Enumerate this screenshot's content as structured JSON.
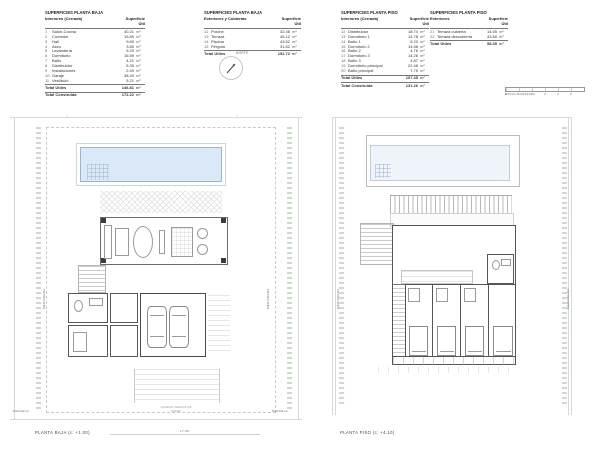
{
  "header": {
    "tables": [
      {
        "title": "SUPERFICIES PLANTA BAJA",
        "group": "Interiores (Cerrada)",
        "value_col": "Superficie Útil",
        "rows": [
          [
            "1",
            "Salón-Cocina",
            "40.21",
            "m²"
          ],
          [
            "2",
            "Comedor",
            "15.80",
            "m²"
          ],
          [
            "3",
            "Hall",
            "9.60",
            "m²"
          ],
          [
            "4",
            "Aseo",
            "3.80",
            "m²"
          ],
          [
            "5",
            "Lavandería",
            "5.20",
            "m²"
          ],
          [
            "6",
            "Dormitorio",
            "16.59",
            "m²"
          ],
          [
            "7",
            "Baño",
            "4.21",
            "m²"
          ],
          [
            "8",
            "Distribuidor",
            "5.30",
            "m²"
          ],
          [
            "9",
            "Instalaciones",
            "2.49",
            "m²"
          ],
          [
            "10",
            "Garaje",
            "38.40",
            "m²"
          ],
          [
            "11",
            "Vestíbulo",
            "5.21",
            "m²"
          ]
        ],
        "totals": [
          [
            "Total Útiles",
            "146.81",
            "m²"
          ],
          [
            "Total Construida",
            "172.22",
            "m²"
          ]
        ]
      },
      {
        "title": "SUPERFICIES PLANTA BAJA",
        "group": "Exteriores y Cubiertas",
        "value_col": "Superficie Útil",
        "rows": [
          [
            "12",
            "Porche",
            "32.46",
            "m²"
          ],
          [
            "13",
            "Terraza",
            "45.12",
            "m²"
          ],
          [
            "14",
            "Piscina",
            "43.52",
            "m²"
          ],
          [
            "15",
            "Pérgola",
            "31.62",
            "m²"
          ]
        ],
        "totals": [
          [
            "Total Útiles",
            "152.72",
            "m²"
          ]
        ]
      },
      {
        "title": "SUPERFICIES PLANTA PISO",
        "group": "Interiores (Cerrada)",
        "value_col": "Superficie Útil",
        "rows": [
          [
            "12",
            "Distribuidor",
            "18.74",
            "m²"
          ],
          [
            "13",
            "Dormitorio 1",
            "14.78",
            "m²"
          ],
          [
            "14",
            "Baño 1",
            "5.23",
            "m²"
          ],
          [
            "15",
            "Dormitorio 2",
            "14.58",
            "m²"
          ],
          [
            "16",
            "Baño 2",
            "4.76",
            "m²"
          ],
          [
            "17",
            "Dormitorio 3",
            "14.26",
            "m²"
          ],
          [
            "18",
            "Baño 3",
            "4.87",
            "m²"
          ],
          [
            "19",
            "Dormitorio principal",
            "22.48",
            "m²"
          ],
          [
            "20",
            "Baño principal",
            "7.75",
            "m²"
          ]
        ],
        "totals": [
          [
            "Total Útiles",
            "107.45",
            "m²"
          ],
          [
            "Total Construida",
            "131.26",
            "m²"
          ]
        ]
      },
      {
        "title": "SUPERFICIES PLANTA PISO",
        "group": "Exteriores",
        "value_col": "Superficie Útil",
        "rows": [
          [
            "21",
            "Terraza cubierta",
            "14.55",
            "m²"
          ],
          [
            "22",
            "Terraza descubierta",
            "43.80",
            "m²"
          ]
        ],
        "totals": [
          [
            "Total Útiles",
            "58.35",
            "m²"
          ]
        ]
      }
    ],
    "north_label": "NORTE",
    "scale": {
      "label": "ESCALA GRÁFICA",
      "ticks": [
        "0",
        "1",
        "2",
        "3",
        "4",
        "5"
      ]
    }
  },
  "plans": {
    "left": {
      "caption": "PLANTA BAJA  (c: +1.00)",
      "side_left": "MEDIANERA",
      "side_right": "MEDIANERA",
      "note1": "ACCESO VEHÍCULOS",
      "note2": "ACERA",
      "corner_left": "PARCELA",
      "corner_right": "PARCELA",
      "dim": "17.00",
      "survey_mark": "+"
    },
    "right": {
      "caption": "PLANTA PISO  (c: +4.10)",
      "side_left": "MEDIANERA",
      "side_right": "MEDIANERA"
    }
  }
}
